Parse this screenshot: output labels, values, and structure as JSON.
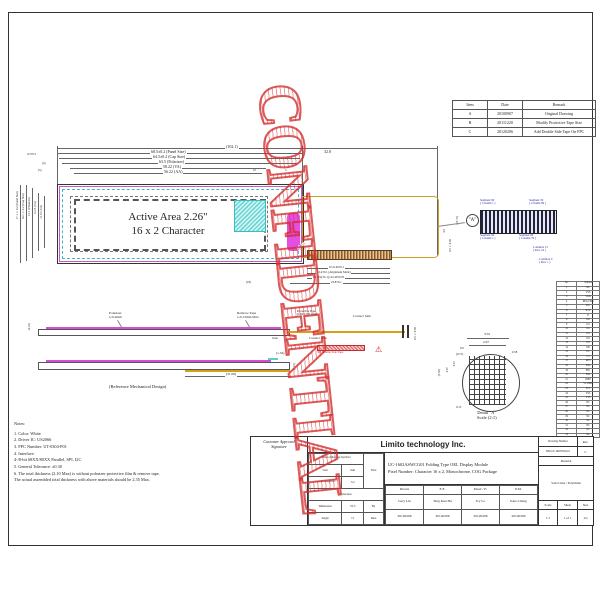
{
  "watermark": {
    "text": "CONFIDENTIAL"
  },
  "revision": {
    "headers": [
      "Item",
      "Date",
      "Remark"
    ],
    "rows": [
      [
        "A",
        "20100907",
        "Original Drawing"
      ],
      [
        "B",
        "20111220",
        "Modify Protective Tape Size"
      ],
      [
        "C",
        "20120206",
        "Add Double Side Tape On FPC"
      ]
    ]
  },
  "front": {
    "active_area_line1": "Active Area 2.26\"",
    "active_area_line2": "16 x 2 Character",
    "dims_top": [
      "(102.1)",
      "68.5±0.2 (Panel Size)",
      "64.5±0.2 (Cap Size)",
      "63.5 (Polarizer)",
      "58.22 (VA)",
      "56.22 (AA)"
    ],
    "dim_fpc": "32.8",
    "dims_misc_left": [
      "0.5±0.5",
      "(4)",
      "(5)"
    ],
    "dims_misc_right": [
      "10",
      "5"
    ],
    "dims_left": [
      "17.1±0.2 (Panel Size)",
      "16.1±0.2 (Cap Size)",
      "15.1 (Polarizer)",
      "13.15 (VA)",
      "11.15 (AA)"
    ],
    "dim_right_vert": "(15.75)"
  },
  "fpc": {
    "radius": "5-R0.5",
    "pad_dims": [
      "W=0.40±0.1",
      "22.4±0.1 (Alignment Mark)",
      "P0.70x(33-1)=22.40±0.05",
      "23.8±0.1"
    ],
    "dim_18": "(18)",
    "dims_right": [
      "4.5",
      "0.5±0.05"
    ]
  },
  "pads_detail": {
    "callout": "\"A\"",
    "seg_tl1": "Segment 99",
    "seg_tl2": "( Column 1 )",
    "seg_tr1": "Segment 30",
    "seg_tr2": "( Column 99 )",
    "seg_bl1": "Segment 99",
    "seg_bl2": "( Column 1 )",
    "seg_br1": "Segment 60",
    "seg_br2": "( Column 79 )",
    "com15a": "Common 15",
    "com15b": "( Row 16 )",
    "com0a": "Common 0",
    "com0b": "( Row 1 )"
  },
  "side1": {
    "polarizer1": "Polarizer",
    "polarizer2": "t=0.2mm",
    "remove1": "Remove Tape",
    "remove2": "t=0.15mm Max",
    "protect1": "Protective Tape",
    "protect2": "(1.8x3.5±0.1)mm",
    "contact_top": "Contact Side",
    "contact_bottom": "Contact Side",
    "tape3m": "3M Double Side Tape",
    "glue": "Glue",
    "warning": "⚠",
    "thickness": "(2.10)",
    "dim_right": "0.5±0.05"
  },
  "side2": {
    "dim134": "(1.34)",
    "dim3108": "(31.08)",
    "dim215": "(2.15)",
    "caption": "(Reference Mechanical Design)"
  },
  "detail": {
    "d355": "3.55",
    "d297": "2.97",
    "d06": "0.6",
    "d057": "(0.57)",
    "d058": "0.58",
    "d555": "(5.55)",
    "d487": "4.87",
    "d067": "0.67",
    "d013": "0.13",
    "caption1": "Detail \"A\"",
    "caption2": "Scale (2:1)"
  },
  "pin_table": {
    "headers": [
      "No.",
      "Symbol"
    ],
    "rows": [
      [
        "1",
        "NC"
      ],
      [
        "2",
        "VSS"
      ],
      [
        "3",
        "VDD"
      ],
      [
        "4",
        "REGVDD"
      ],
      [
        "5",
        "D/C"
      ],
      [
        "6",
        "R/W"
      ],
      [
        "7",
        "E"
      ],
      [
        "8",
        "D0"
      ],
      [
        "9",
        "D1"
      ],
      [
        "10",
        "D2"
      ],
      [
        "11",
        "D3"
      ],
      [
        "12",
        "D4"
      ],
      [
        "13",
        "D5"
      ],
      [
        "14",
        "D6"
      ],
      [
        "15",
        "D7"
      ],
      [
        "16",
        "CS"
      ],
      [
        "17",
        "RES"
      ],
      [
        "18",
        "BS0"
      ],
      [
        "19",
        "BS1"
      ],
      [
        "20",
        "BS2"
      ],
      [
        "21",
        "IREF"
      ],
      [
        "22",
        "VCOMH"
      ],
      [
        "23",
        "VCC"
      ],
      [
        "24",
        "VSL"
      ],
      [
        "25",
        "VSS"
      ],
      [
        "26",
        "NC"
      ],
      [
        "27",
        "NC"
      ],
      [
        "28",
        "NC"
      ],
      [
        "29",
        "NC"
      ],
      [
        "30",
        "NC"
      ],
      [
        "31",
        "NC"
      ],
      [
        "32",
        "NC"
      ],
      [
        "33",
        "NC"
      ]
    ]
  },
  "notes": {
    "title": "Notes:",
    "lines": [
      "1. Color: White",
      "2. Driver IC: US2066",
      "3. FPC Number: UT-0304-P01",
      "4. Interface:",
      "    4-/8-bit 68XX/80XX Parallel, SPI, I2C",
      "5. General Tolerance: ±0.30",
      "6. The total thickness (2.10 Max) is without polarizer protective film & remove tape.",
      "    The actual assembled total thickness with above materials should be 2.35 Max."
    ]
  },
  "title_block": {
    "customer1": "Customer Approval",
    "customer2": "Signature",
    "company": "Limito technology Inc.",
    "unless": "Unless Otherwise Specified",
    "unit_label": "Unit",
    "unit_value": "mm",
    "roughness_label": "General Roughness",
    "roughness_value": "3.2",
    "tolerance": "Tolerance",
    "dim_label": "Dimension",
    "dim_value": "±0.3",
    "angle_label": "Angle",
    "angle_value": "±1",
    "by_label": "By",
    "date_label": "Date",
    "title_label": "Title",
    "title1": "UC-1602ASWCG01 Folding Type OEL Display Module",
    "title2": "Pixel Number: Character 16 x 2, Monochrome, COG Package",
    "col_headers": [
      "Drawn",
      "E.E.",
      "Panel / E.",
      "P.M."
    ],
    "names": [
      "Gary Lin",
      "Ting Kun Hu",
      "Ivy Lo",
      "Kate Chang"
    ],
    "dates": [
      "20120206",
      "20120206",
      "20120206",
      "20120206"
    ],
    "dn_label": "Drawing Number",
    "dn_value": "DM-UC1602SWG01",
    "rev_label": "Rev.",
    "rev_value": "C",
    "material_label": "Material",
    "material_value": "Soda Lime / Polyimide",
    "scale_label": "Scale",
    "scale_value": "1:1",
    "sheet_label": "Sheet",
    "sheet_value": "1 of 1",
    "size_label": "Size",
    "size_value": "A3"
  }
}
